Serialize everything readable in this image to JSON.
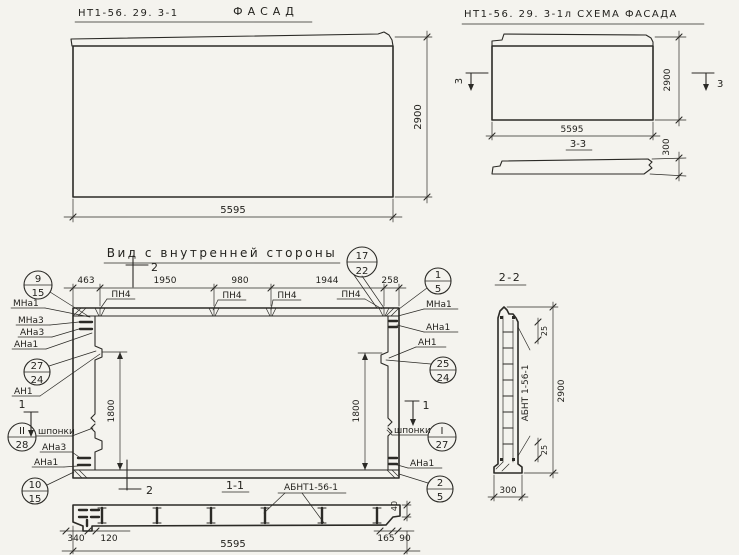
{
  "drawing": {
    "facade": {
      "code": "НТ1-56. 29. 3-1",
      "name": "ФАСАД",
      "width": "5595",
      "height": "2900"
    },
    "schema": {
      "title": "НТ1-56. 29. 3-1л СХЕМА ФАСАДА",
      "width": "5595",
      "height": "2900",
      "cut_left": "3",
      "cut_right": "3",
      "section": "3-3",
      "thickness": "300"
    },
    "inner": {
      "title": "Вид с внутренней стороны",
      "segs": [
        "463",
        "1950",
        "980",
        "1944",
        "258"
      ],
      "pn": [
        "ПН4",
        "ПН4",
        "ПН4",
        "ПН4"
      ],
      "h1": "1800",
      "h2": "1800",
      "cut1_left": "1",
      "cut1_right": "1",
      "cut2_top": "2",
      "cut2_bottom": "2",
      "ll": [
        "МНа1",
        "МНа3",
        "АНа3",
        "АНа1",
        "АН1",
        "шпонки",
        "АНа3",
        "АНа1"
      ],
      "rl": [
        "МНа1",
        "АНа1",
        "АН1",
        "шпонки",
        "АНа1"
      ],
      "co": {
        "c17": {
          "t": "17",
          "b": "22"
        },
        "c9": {
          "t": "9",
          "b": "15"
        },
        "c27": {
          "t": "27",
          "b": "24"
        },
        "c28": {
          "t": "II",
          "b": "28"
        },
        "c10": {
          "t": "10",
          "b": "15"
        },
        "c1": {
          "t": "1",
          "b": "5"
        },
        "c25": {
          "t": "25",
          "b": "24"
        },
        "cI": {
          "t": "I",
          "b": "27"
        },
        "c2": {
          "t": "2",
          "b": "5"
        }
      }
    },
    "s11": {
      "title": "1-1",
      "part": "АБНТ1-56-1",
      "d1": "340",
      "d2": "120",
      "d3": "165",
      "d4": "90",
      "d5": "40",
      "total": "5595"
    },
    "s22": {
      "title": "2-2",
      "part": "АБНТ 1-56-1",
      "top": "25",
      "bottom": "25",
      "height": "2900",
      "width": "300"
    }
  }
}
